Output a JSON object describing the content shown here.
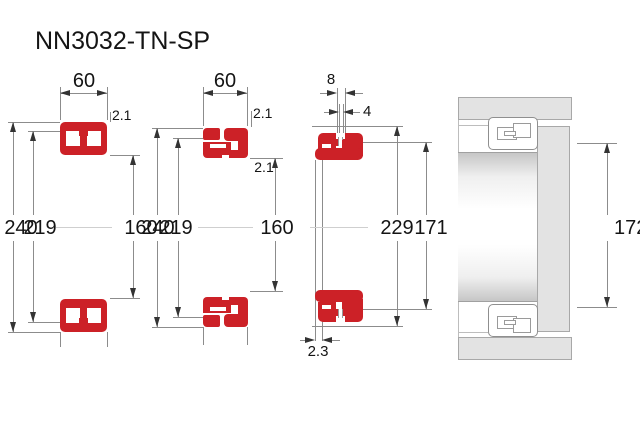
{
  "title": "NN3032-TN-SP",
  "colors": {
    "bearing_red": "#cc2127",
    "dimension_line": "#8c8c8c",
    "housing_fill": "#e3e3e3",
    "housing_border": "#a8a8a8",
    "text": "#141414"
  },
  "views": {
    "front_section": {
      "width": "60",
      "outer_diameter": "240",
      "raceway_diameter": "219",
      "bore_diameter": "160",
      "chamfer": "2.1"
    },
    "cage_section": {
      "width": "60",
      "outer_diameter": "240",
      "raceway_diameter": "219",
      "bore_diameter": "160",
      "chamfer_outer": "2.1",
      "chamfer_inner": "2.1"
    },
    "inner_ring_section": {
      "groove_width": "8",
      "hole_diameter": "4",
      "shoulder_diameter": "229",
      "abutment_diameter": "171",
      "face_offset": "2.3"
    },
    "mounting_view": {
      "recess_diameter": "172"
    }
  }
}
